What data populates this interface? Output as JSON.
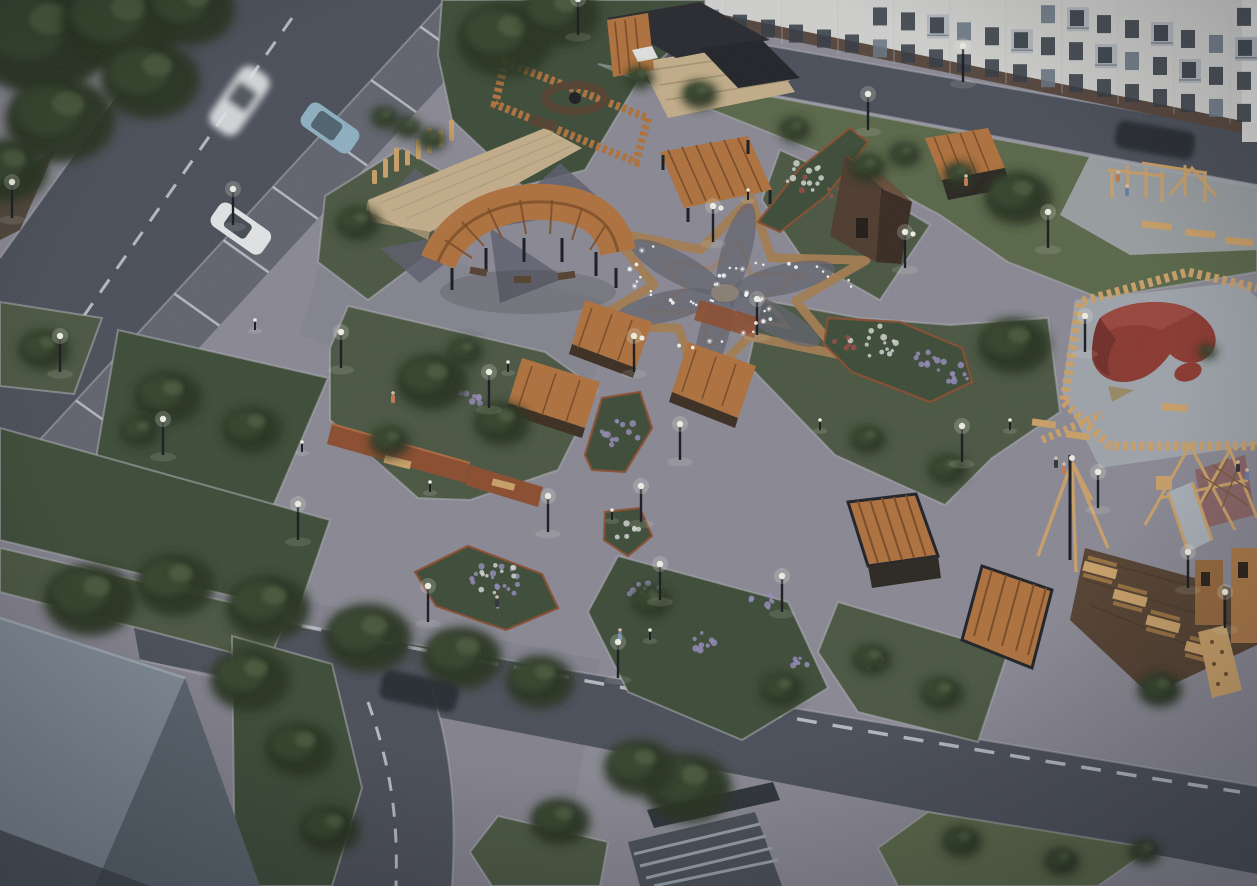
{
  "scene": {
    "title": "Aerial dusk rendering of a landscaped residential courtyard park with star-paved plaza, timber pavilions and playground",
    "view": "high-angle aerial 3D visualization",
    "time_of_day": "dusk, lamps lit"
  },
  "palette": {
    "base-pavement": "#8d8b95",
    "plaza-shadow": "#6f6e7a",
    "road": "#4b4f58",
    "road-dark": "#3f434b",
    "road-line": "#ced1d6",
    "curb": "#b6b4bc",
    "lawn": "#4a5740",
    "lawn-dark": "#3d4b35",
    "lawn-light": "#5a6847",
    "tree-dark": "#27331f",
    "tree-mid": "#36452c",
    "bush-light": "#61714c",
    "flower-purple": "#988dbb",
    "flower-white": "#d7dcd4",
    "flower-red": "#9c4a44",
    "soil": "#4e4437",
    "star-tan": "#a87e4f",
    "star-petal": "#63626e",
    "pinwheel": "#5e5e6c",
    "wood-orange": "#b4723a",
    "wood-slat-dark": "#7c4a22",
    "wood-light": "#cfa368",
    "wood-deck": "#c9b28b",
    "wood-dark": "#5f442c",
    "deck-dark": "#55402e",
    "corten": "#8f4c2c",
    "rubber-red": "#8e372d",
    "rubber-red-dark": "#6e2a24",
    "rubber-pad": "#a3a7ad",
    "roof-light": "#7f8a94",
    "roof-mid": "#59626c",
    "roof-dark": "#3a3f46",
    "glassroof-rib": "#9aa3ab",
    "building-wall": "#d6d5d2",
    "building-plinth": "#57453a",
    "window": "#343a42",
    "window-lit": "#6b7683",
    "balcony": "#b7bcc1",
    "lamp-pole": "#17191d",
    "lamp-glow": "#f6f6e8",
    "string-light": "#ffffff",
    "car-white": "#e9eaeb",
    "car-blue": "#92b4c5",
    "car-dark": "#23272d",
    "person-orange": "#c77b52",
    "person-blue": "#6a7fa8",
    "person-dark": "#2e3237"
  },
  "objects": {
    "building": {
      "name": "prefab apartment block facade",
      "rows_of_windows_visible": 4,
      "location": "top edge"
    },
    "roads": [
      {
        "name": "parking street",
        "location": "top-left",
        "markings": "dashed centerline, perpendicular parking bays"
      },
      {
        "name": "service drive along building",
        "location": "top"
      },
      {
        "name": "courtyard loop road",
        "location": "bottom",
        "markings": "dashed centerline, branch to bottom edge"
      }
    ],
    "cars": [
      {
        "name": "moving car (motion-blurred)",
        "color": "white",
        "location": "parking street"
      },
      {
        "name": "parked hatchback",
        "color": "light blue",
        "location": "parking bay"
      },
      {
        "name": "parked sedan",
        "color": "white",
        "location": "parking bay"
      },
      {
        "name": "moving car",
        "color": "dark",
        "location": "drive along building"
      },
      {
        "name": "moving car",
        "color": "dark",
        "location": "bottom road"
      }
    ],
    "park_features": [
      "timber event stage with log sculpture poles",
      "fire-pit lounge enclosed by timber fence",
      "slat pavilion with dark kiosk and deck steps",
      "curved timber pergola with benches",
      "six-point star paving with string lights",
      "pinwheel paving pattern",
      "three wedge-shaped timber shelters",
      "angular timber cabin",
      "corten-steel planter walls with benches",
      "lilac and white flower beds with corten edging",
      "outdoor gym pad with timber frames",
      "log-fenced toddler area with red rubber mounds",
      "rope climbing frame and metal slide",
      "tipi swing frame",
      "picnic deck with four tables",
      "play tower with climbing ramp",
      "two slat pergola cubes",
      "slatted glass-roof canopy",
      "gabled roof of neighbouring building"
    ],
    "lighting": {
      "street_lamps": 27,
      "bollard_lights": 9,
      "string_lights_over_plaza": true
    },
    "people": [
      "jogger",
      "walkers",
      "children at playground",
      "person resting in shelter"
    ]
  }
}
